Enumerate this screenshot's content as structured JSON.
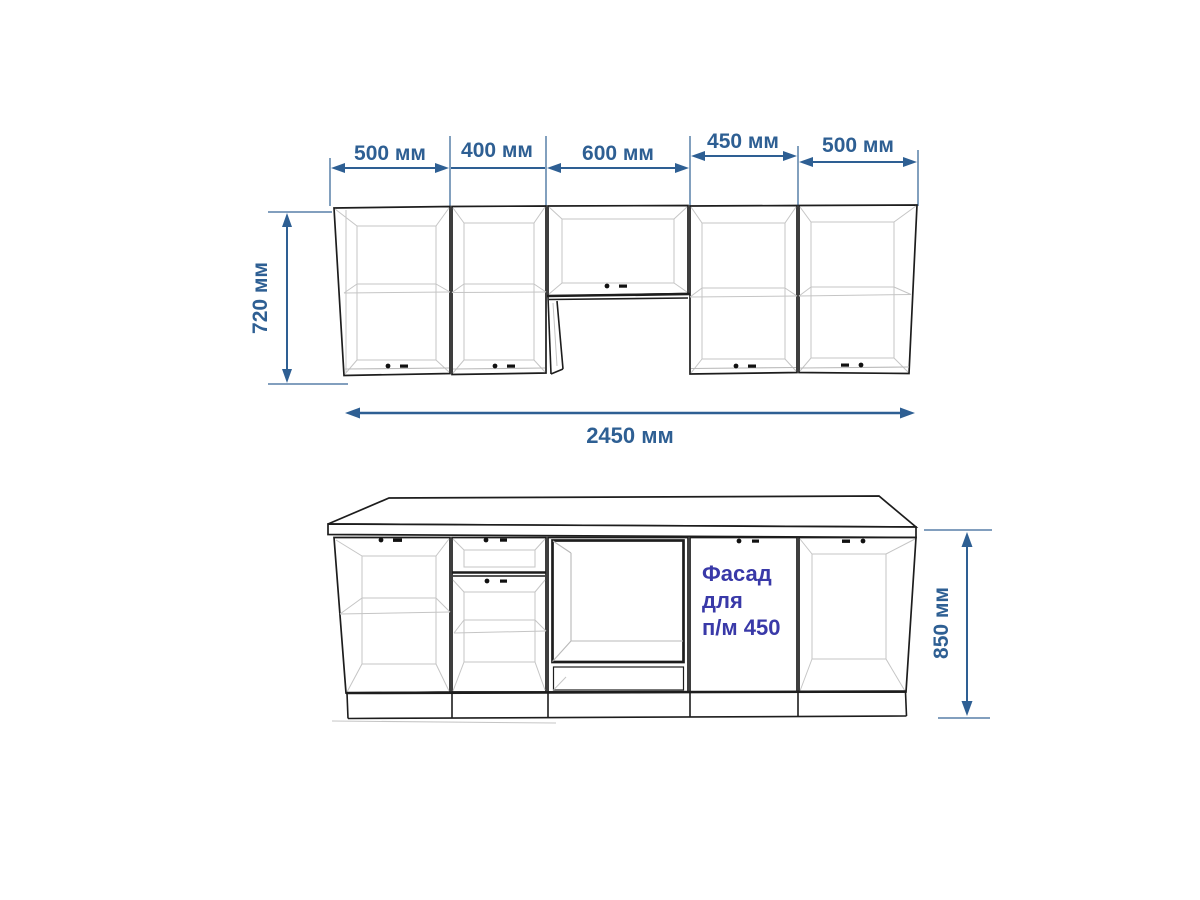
{
  "colors": {
    "dimension_blue": "#2e5f93",
    "annotation_indigo": "#3939a8",
    "outline_dark": "#1d1d1d",
    "interior_gray": "#c5c5c5",
    "background": "#ffffff"
  },
  "upper_view": {
    "width_dimensions": [
      {
        "label": "500 мм",
        "value_mm": 500
      },
      {
        "label": "400 мм",
        "value_mm": 400
      },
      {
        "label": "600 мм",
        "value_mm": 600
      },
      {
        "label": "450 мм",
        "value_mm": 450
      },
      {
        "label": "500 мм",
        "value_mm": 500
      }
    ],
    "height_dimension": {
      "label": "720 мм",
      "value_mm": 720
    },
    "total_width_dimension": {
      "label": "2450 мм",
      "value_mm": 2450
    }
  },
  "lower_view": {
    "height_dimension": {
      "label": "850 мм",
      "value_mm": 850
    },
    "dishwasher_note": {
      "line1": "Фасад",
      "line2": "для",
      "line3": "п/м 450"
    }
  }
}
